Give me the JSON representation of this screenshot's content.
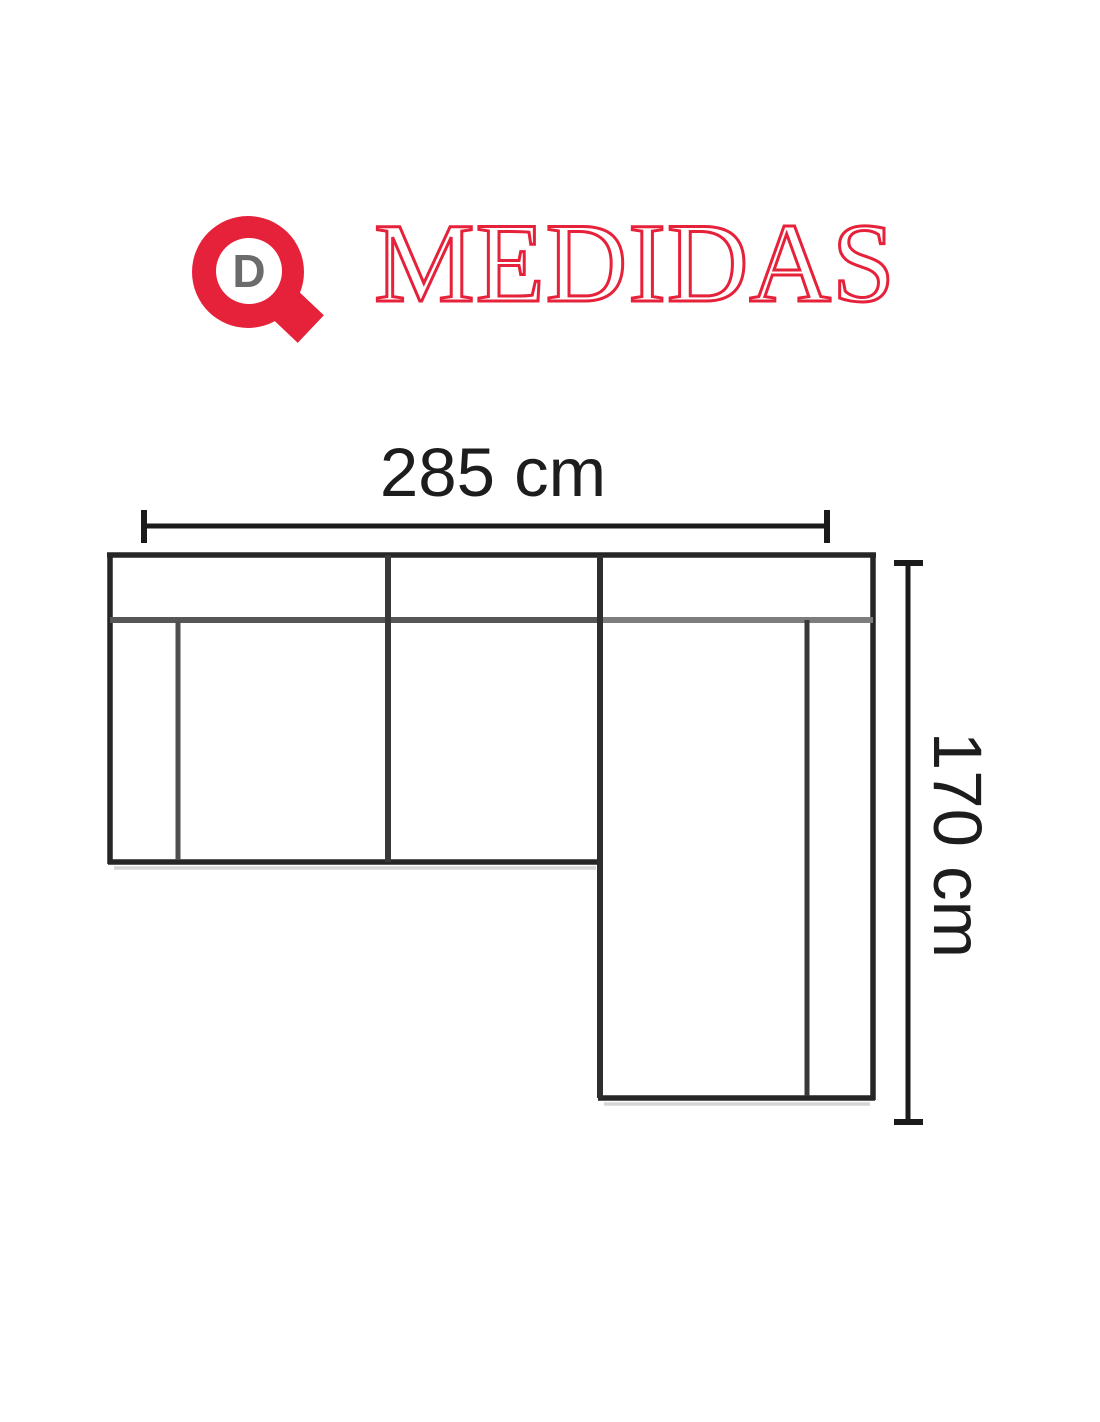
{
  "header": {
    "title_text": "MEDIDAS",
    "logo_letter": "D",
    "brand_red": "#e6213a",
    "logo_letter_gray": "#6b6b6b"
  },
  "diagram": {
    "type": "sofa-top-view-dimension-drawing",
    "width_label": "285 cm",
    "height_label": "170 cm",
    "dimensions": {
      "width_cm": 285,
      "depth_cm": 170
    },
    "colors": {
      "outline_dark": "#262626",
      "dimension_line": "#1b1b1b",
      "inner_divider": "#383838",
      "backrest_seam_gray": "#6f6f6f",
      "label_text": "#1d1d1d"
    }
  }
}
